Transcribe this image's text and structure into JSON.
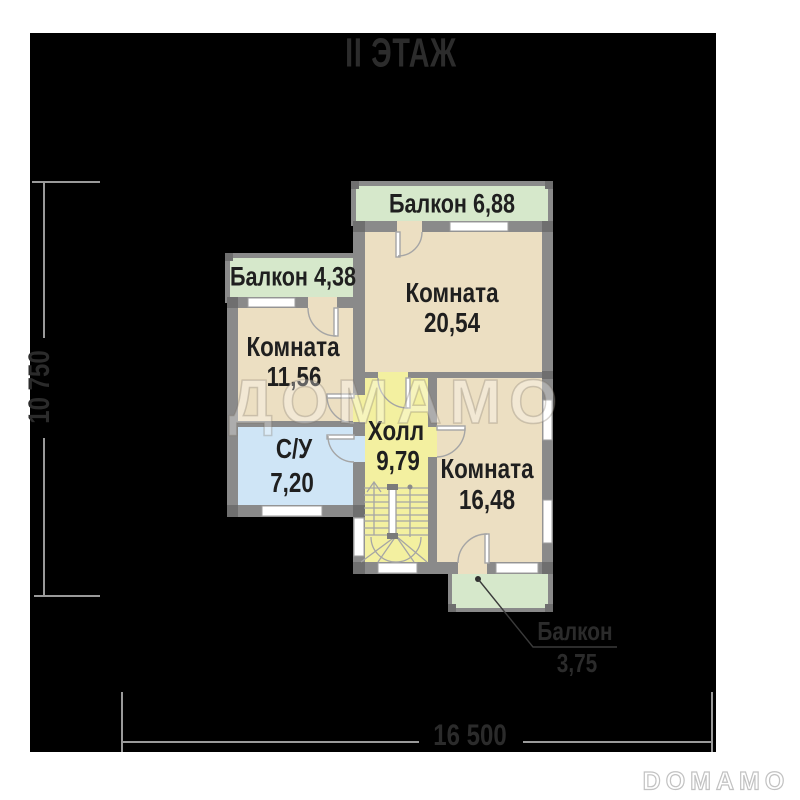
{
  "title": "II ЭТАЖ",
  "watermark": "ДОМАМО",
  "logo": "DOMAMO",
  "plan": {
    "floor": "2",
    "rooms": [
      {
        "id": "balcony-top",
        "name": "Балкон",
        "area": "6,88"
      },
      {
        "id": "room-20",
        "name": "Комната",
        "area": "20,54"
      },
      {
        "id": "balcony-left",
        "name": "Балкон",
        "area": "4,38"
      },
      {
        "id": "room-11",
        "name": "Комната",
        "area": "11,56"
      },
      {
        "id": "bathroom",
        "name": "С/У",
        "area": "7,20"
      },
      {
        "id": "hall",
        "name": "Холл",
        "area": "9,79"
      },
      {
        "id": "room-16",
        "name": "Комната",
        "area": "16,48"
      },
      {
        "id": "balcony-bottom",
        "name": "Балкон",
        "area": "3,75"
      }
    ],
    "dimensions": {
      "height_label": "10 750",
      "width_label": "16 500"
    },
    "colors": {
      "room": "#ecdfc2",
      "balcony": "#d6e8cb",
      "bathroom": "#cfe5f6",
      "hall": "#f3f0a0",
      "wall": "#8a8a8a",
      "wall_dark": "#6f6f6f",
      "window": "#ffffff",
      "line": "#a5a5a5",
      "dim_line": "#9a9a9a",
      "background": "#000000"
    }
  }
}
